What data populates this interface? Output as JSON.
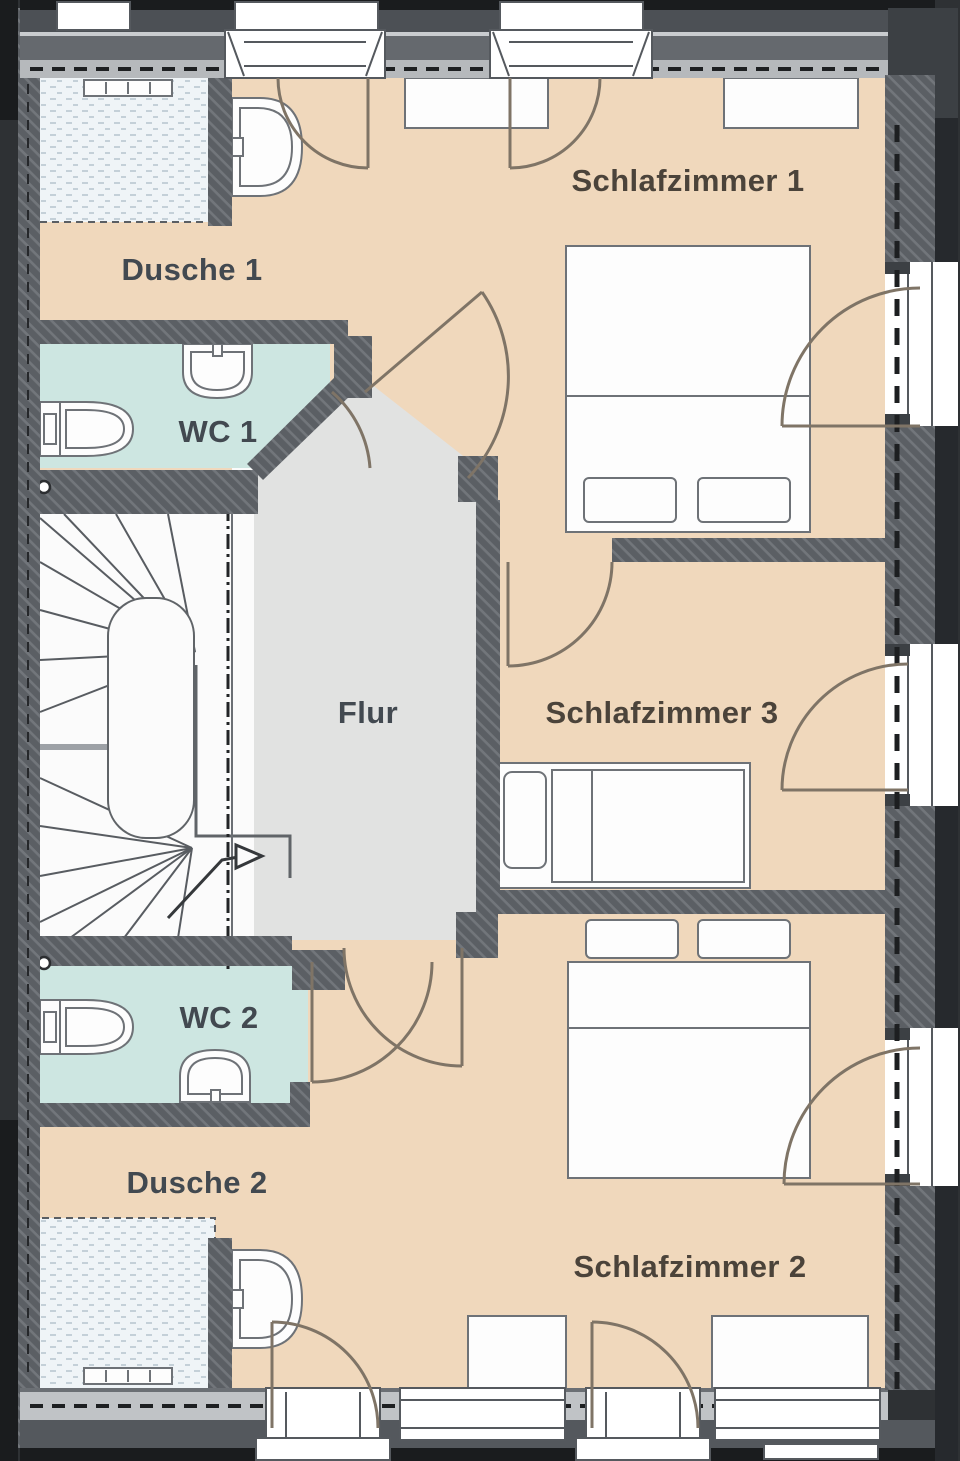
{
  "rooms": {
    "schlafzimmer1": {
      "label": "Schlafzimmer 1"
    },
    "schlafzimmer2": {
      "label": "Schlafzimmer 2"
    },
    "schlafzimmer3": {
      "label": "Schlafzimmer 3"
    },
    "dusche1": {
      "label": "Dusche 1"
    },
    "dusche2": {
      "label": "Dusche 2"
    },
    "wc1": {
      "label": "WC 1"
    },
    "wc2": {
      "label": "WC 2"
    },
    "flur": {
      "label": "Flur"
    }
  },
  "colors": {
    "wall": "#5b5f64",
    "wall-hatch": "#72767b",
    "wall-dark": "#3c4044",
    "outer-black": "#1a1c1e",
    "outer-gray": "#4c5055",
    "band-mid": "#65696e",
    "band-light": "#b6b9bc",
    "floor-bedroom": "#f0d8bc",
    "floor-bath": "#cde6e1",
    "floor-hall": "#e1e2e1",
    "floor-stair": "#fbfbfb",
    "floor-shower": "#eff4f7",
    "shower-speckle": "#b9c8d1",
    "fixture-stroke": "#6e7277",
    "door-arc": "#7f7466",
    "party-line": "#1d1f21",
    "label-warm": "#4b433a",
    "label-cool": "#424950"
  }
}
